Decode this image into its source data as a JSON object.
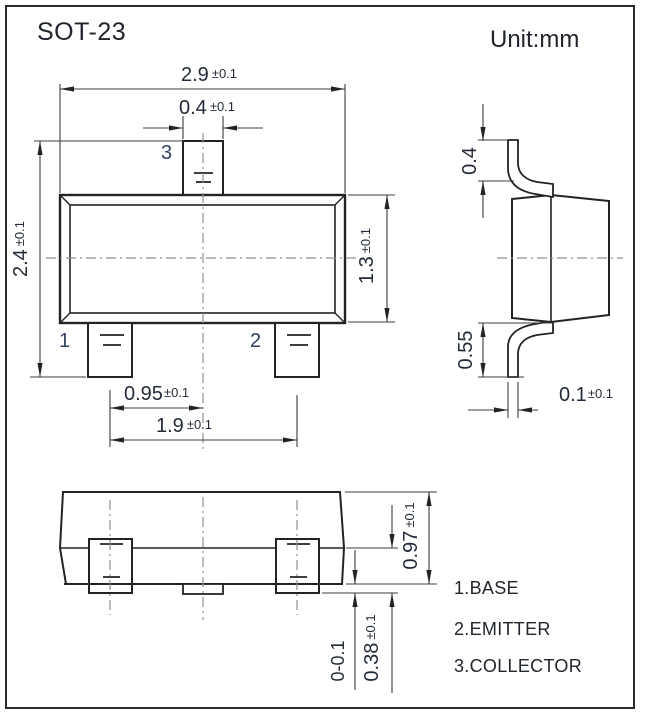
{
  "title": "SOT-23",
  "unit": "Unit:mm",
  "pins": {
    "p1": "1",
    "p2": "2",
    "p3": "3"
  },
  "dimensions": {
    "body_width": {
      "value": "2.9",
      "tol": "±0.1"
    },
    "pin3_width": {
      "value": "0.4",
      "tol": "±0.1"
    },
    "overall_height": {
      "value": "2.4",
      "tol": "±0.1"
    },
    "body_height": {
      "value": "1.3",
      "tol": "±0.1"
    },
    "pin_pitch": {
      "value": "0.95",
      "tol": "±0.1"
    },
    "pin_span": {
      "value": "1.9",
      "tol": "±0.1"
    },
    "lead_tip_height": {
      "value": "0.4",
      "tol": ""
    },
    "lead_bend_height": {
      "value": "0.55",
      "tol": ""
    },
    "lead_thickness": {
      "value": "0.1",
      "tol": "±0.1"
    },
    "front_body_height": {
      "value": "0.97",
      "tol": "±0.1"
    },
    "lead_foot_height": {
      "value": "0.38",
      "tol": "±0.1"
    },
    "standoff": {
      "value": "0-0.1",
      "tol": ""
    }
  },
  "legend": [
    "1.BASE",
    "2.EMITTER",
    "3.COLLECTOR"
  ],
  "colors": {
    "line": "#232323",
    "dim_line": "#3d3d3d",
    "centerline": "#8f8f8f",
    "text": "#232a38"
  }
}
